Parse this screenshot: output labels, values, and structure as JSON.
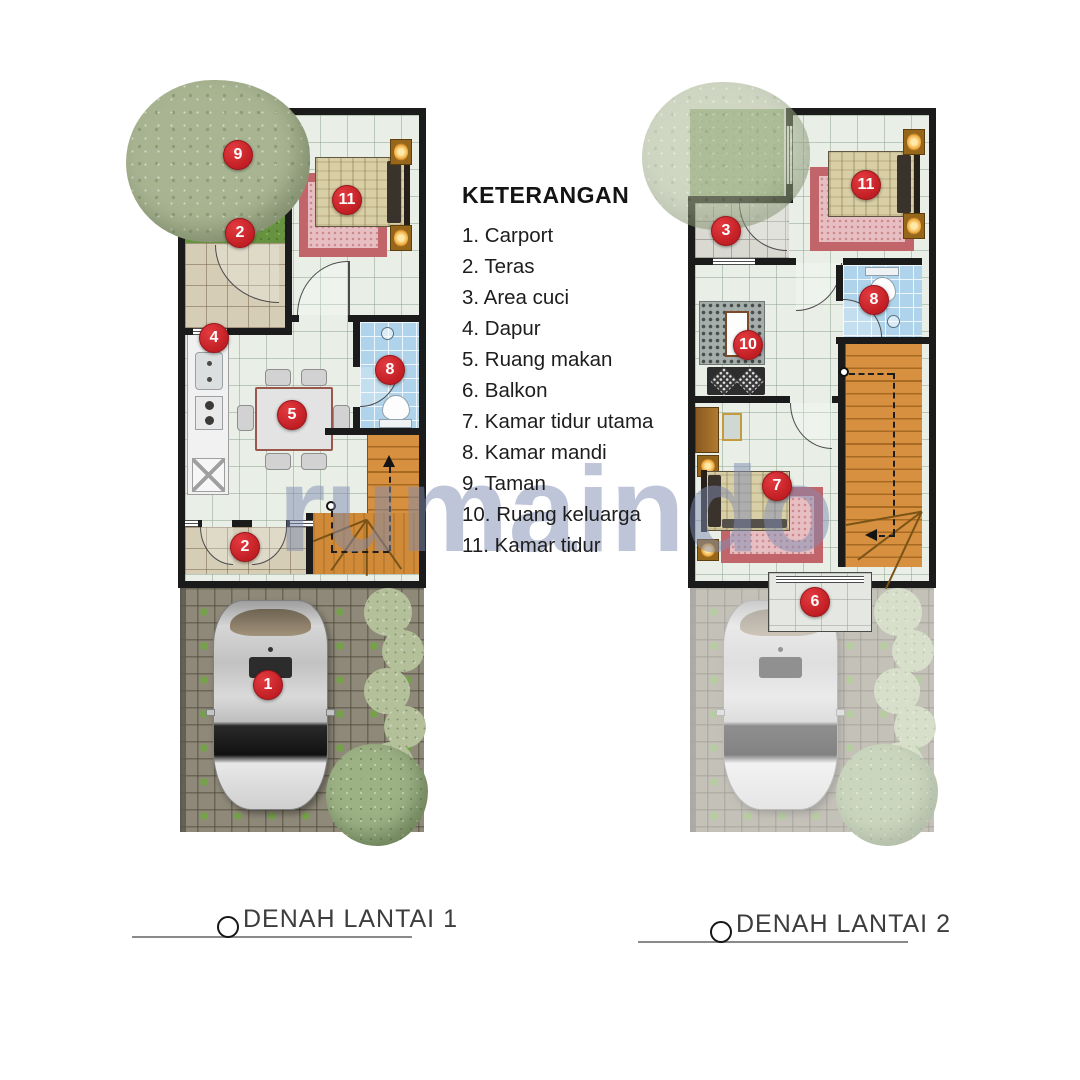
{
  "legend": {
    "title": "KETERANGAN",
    "items": [
      "1. Carport",
      "2. Teras",
      "3. Area cuci",
      "4. Dapur",
      "5. Ruang makan",
      "6. Balkon",
      "7. Kamar tidur utama",
      "8. Kamar mandi",
      "9. Taman",
      "10. Ruang keluarga",
      "11. Kamar tidur"
    ]
  },
  "watermark": "rumaindo",
  "floor1": {
    "title": "DENAH LANTAI 1",
    "badges": {
      "taman": "9",
      "teras_atas": "2",
      "kamar_tidur": "11",
      "dapur": "4",
      "ruang_makan": "5",
      "kamar_mandi": "8",
      "teras_depan": "2",
      "carport": "1"
    }
  },
  "floor2": {
    "title": "DENAH LANTAI 2",
    "badges": {
      "area_cuci": "3",
      "kamar_tidur": "11",
      "kamar_mandi": "8",
      "ruang_keluarga": "10",
      "kamar_tidur_utama": "7",
      "balkon": "6"
    }
  },
  "colors": {
    "badge_red": "#c6242b",
    "wall_black": "#1b1b1b",
    "stair_wood": "#d69040",
    "bathroom_blue": "#aed3ea",
    "grass_green": "#67923f",
    "watermark_blue": "#8290b2"
  }
}
